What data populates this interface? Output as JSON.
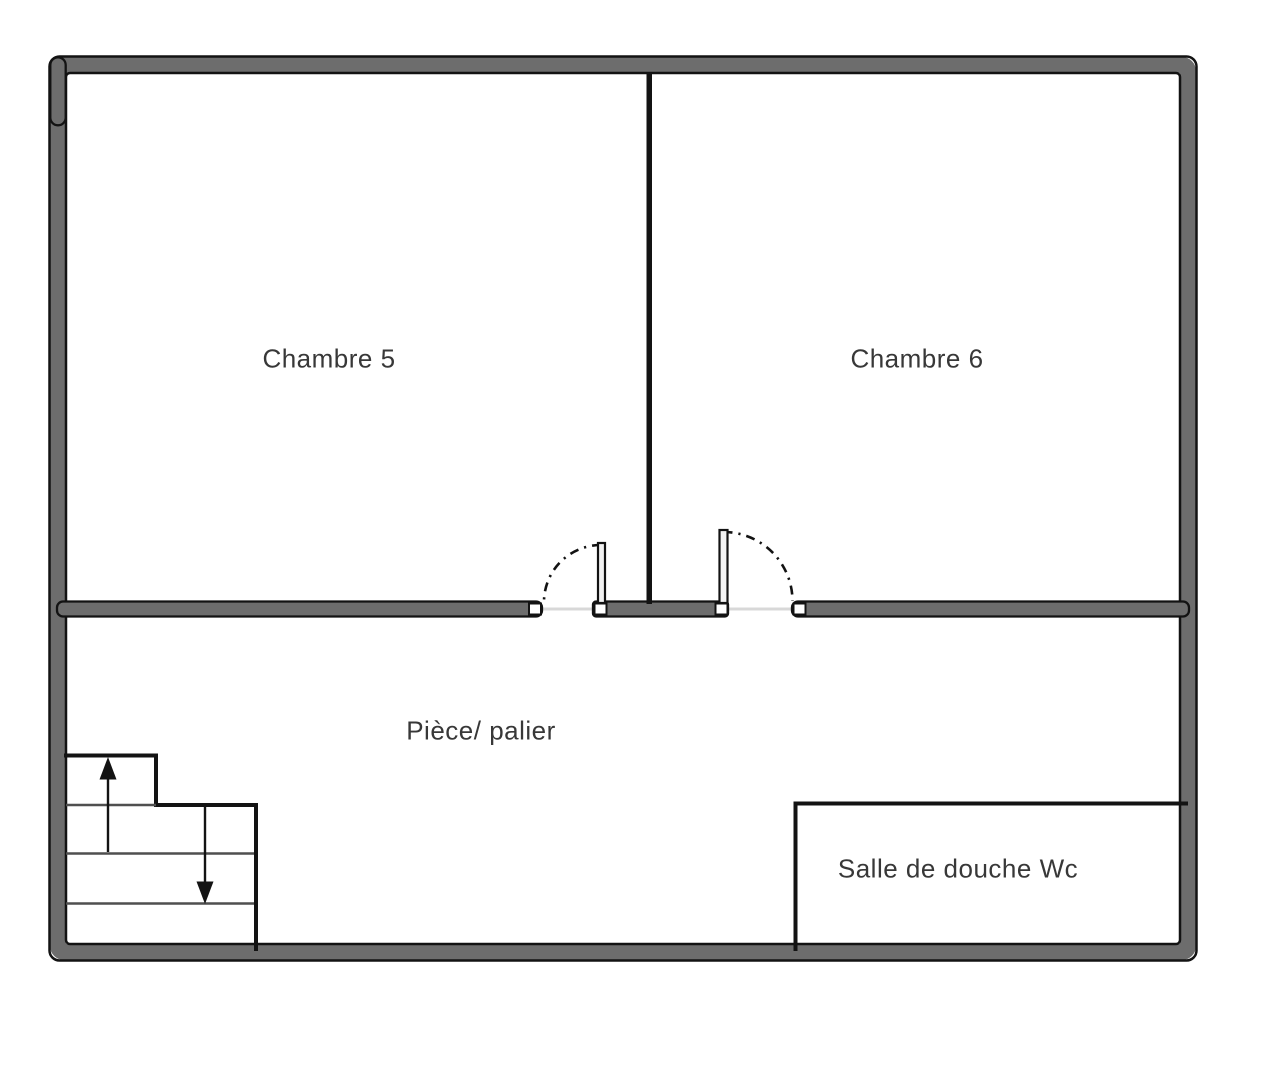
{
  "colors": {
    "bg": "#ffffff",
    "wall-fill": "#6d6d6d",
    "outline": "#131313",
    "tread": "#4f4f4f",
    "threshold": "#d8d8d8",
    "door-fill": "#f2f2f2",
    "jamb-fill": "#ffffff",
    "text": "#383838"
  },
  "rooms": {
    "chambre5": {
      "label": "Chambre 5"
    },
    "chambre6": {
      "label": "Chambre 6"
    },
    "palier": {
      "label": "Pièce/ palier"
    },
    "salle_de_douche": {
      "label": "Salle de douche Wc"
    }
  }
}
